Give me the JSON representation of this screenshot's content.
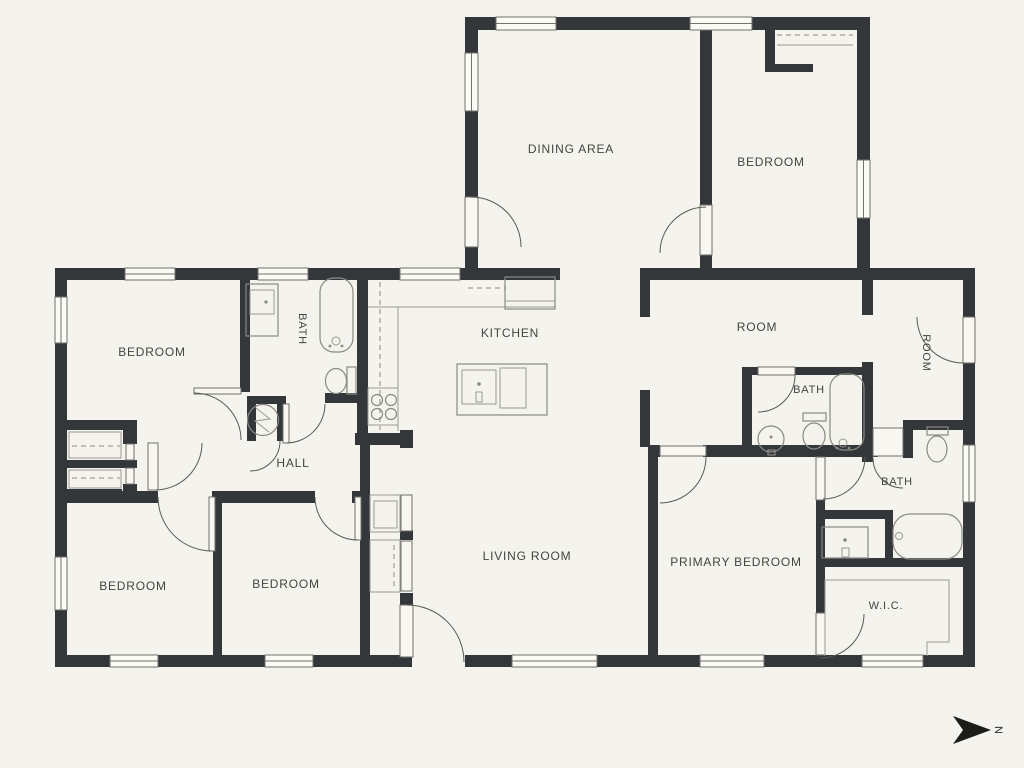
{
  "title": "floor-plan",
  "colors": {
    "background": "#f4f3ee",
    "wall": "#33373a",
    "fixture_line": "#8a8a83",
    "text": "#45453f"
  },
  "rooms": [
    {
      "id": "dining-area",
      "label": "DINING AREA"
    },
    {
      "id": "bedroom-top-right",
      "label": "BEDROOM"
    },
    {
      "id": "bedroom-left",
      "label": "BEDROOM"
    },
    {
      "id": "bath-left",
      "label": "BATH"
    },
    {
      "id": "kitchen",
      "label": "KITCHEN"
    },
    {
      "id": "room-center-right",
      "label": "ROOM"
    },
    {
      "id": "room-right-small",
      "label": "ROOM"
    },
    {
      "id": "bath-upper-right",
      "label": "BATH"
    },
    {
      "id": "hall",
      "label": "HALL"
    },
    {
      "id": "bath-lower-right",
      "label": "BATH"
    },
    {
      "id": "bedroom-bottom-left-1",
      "label": "BEDROOM"
    },
    {
      "id": "bedroom-bottom-left-2",
      "label": "BEDROOM"
    },
    {
      "id": "living-room",
      "label": "LIVING ROOM"
    },
    {
      "id": "primary-bedroom",
      "label": "PRIMARY BEDROOM"
    },
    {
      "id": "walk-in-closet",
      "label": "W.I.C."
    }
  ],
  "north_indicator": {
    "label": "N"
  },
  "fixtures": [
    "bathtub",
    "toilet",
    "vanity-sink",
    "round-sink",
    "range-stove-burners",
    "refrigerator",
    "kitchen-island",
    "island-sink",
    "water-heater",
    "closet-rod-dashed-line",
    "window",
    "door-swing",
    "walk-in-closet-shelving"
  ]
}
